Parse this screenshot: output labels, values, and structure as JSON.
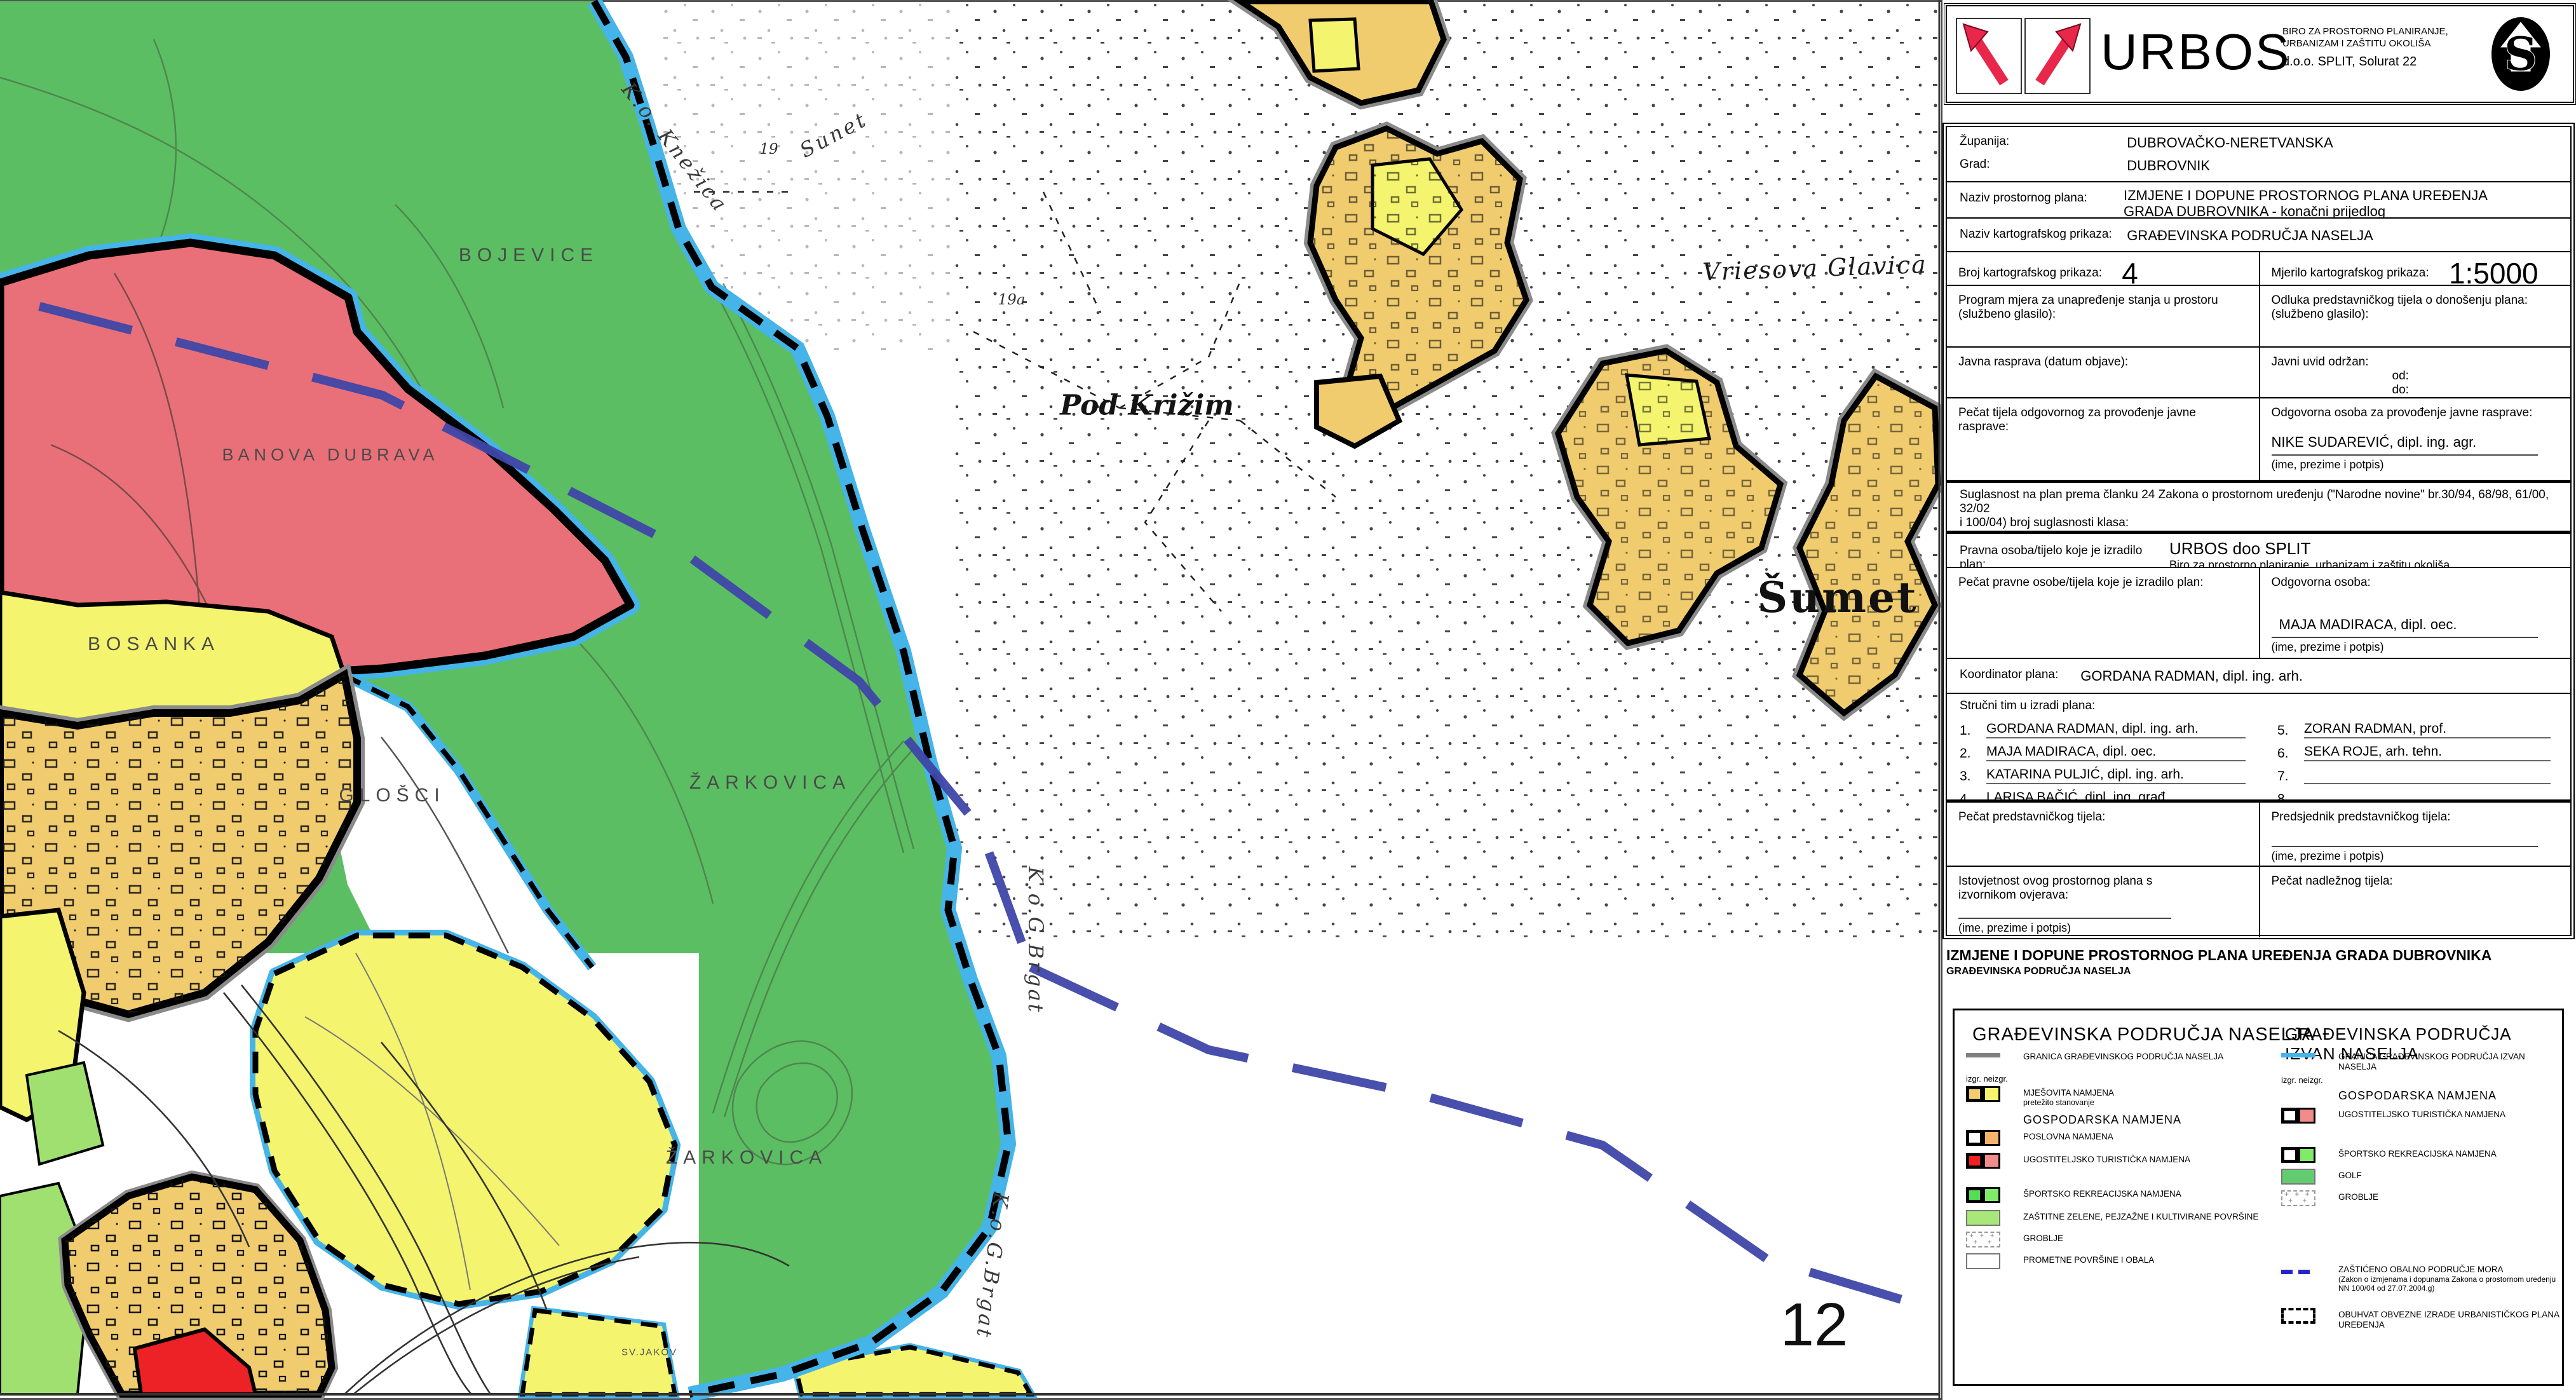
{
  "header": {
    "brand": "URBOS",
    "tagline1": "BIRO ZA PROSTORNO PLANIRANJE,",
    "tagline2": "URBANIZAM I ZAŠTITU OKOLIŠA",
    "address": "d.o.o. SPLIT, Solurat 22",
    "logo_letter": "S"
  },
  "title_block": {
    "zupanija_label": "Županija:",
    "zupanija_value": "DUBROVAČKO-NERETVANSKA",
    "grad_label": "Grad:",
    "grad_value": "DUBROVNIK",
    "naziv_plana_label": "Naziv prostornog plana:",
    "naziv_plana_value1": "IZMJENE I DOPUNE PROSTORNOG PLANA UREĐENJA",
    "naziv_plana_value2": "GRADA DUBROVNIKA - konačni prijedlog",
    "naziv_prikaza_label": "Naziv kartografskog prikaza:",
    "naziv_prikaza_value": "GRAĐEVINSKA PODRUČJA NASELJA",
    "broj_label": "Broj kartografskog prikaza:",
    "broj_value": "4",
    "mjerilo_label": "Mjerilo kartografskog prikaza:",
    "mjerilo_value": "1:5000",
    "program_label1": "Program mjera za unapređenje stanja u prostoru",
    "program_label2": "(službeno glasilo):",
    "odluka_label1": "Odluka predstavničkog tijela o donošenju plana:",
    "odluka_label2": "(službeno glasilo):",
    "javna_label": "Javna rasprava (datum objave):",
    "javni_uvid_label": "Javni uvid održan:",
    "od_label": "od:",
    "do_label": "do:",
    "pecat_tijela_label": "Pečat tijela odgovornog za provođenje javne rasprave:",
    "odgovorna_rasprava_label": "Odgovorna osoba za provođenje javne rasprave:",
    "odgovorna_rasprava_name": "NIKE SUDAREVIĆ, dipl. ing. agr.",
    "ime_potpis": "(ime, prezime i potpis)",
    "suglasnost_text1": "Suglasnost na plan prema članku 24 Zakona o prostornom uređenju (\"Narodne novine\" br.30/94, 68/98, 61/00, 32/02",
    "suglasnost_text2": "i 100/04) broj suglasnosti klasa:",
    "datum_label": "datum:",
    "pravna_label": "Pravna osoba/tijelo koje je izradilo plan:",
    "pravna_value1": "URBOS doo SPLIT",
    "pravna_value2": "Biro za prostorno planiranje, urbanizam i zaštitu okoliša",
    "pecat_pravne_label": "Pečat pravne osobe/tijela koje je izradilo plan:",
    "odgovorna_label": "Odgovorna osoba:",
    "odgovorna_name": "MAJA MADIRACA,  dipl. oec.",
    "koordinator_label": "Koordinator plana:",
    "koordinator_value": "GORDANA RADMAN,  dipl. ing. arh.",
    "tim_label": "Stručni tim u izradi plana:",
    "tim": [
      {
        "num": "1.",
        "name": "GORDANA RADMAN,  dipl. ing. arh."
      },
      {
        "num": "2.",
        "name": "MAJA MADIRACA,  dipl. oec."
      },
      {
        "num": "3.",
        "name": "KATARINA PULJIĆ,  dipl. ing. arh."
      },
      {
        "num": "4.",
        "name": "LARISA BAČIĆ,  dipl. ing. građ."
      },
      {
        "num": "5.",
        "name": "ZORAN RADMAN,  prof."
      },
      {
        "num": "6.",
        "name": "SEKA ROJE,  arh. tehn."
      },
      {
        "num": "7.",
        "name": ""
      },
      {
        "num": "8.",
        "name": ""
      }
    ],
    "pecat_predstavnickog_label": "Pečat predstavničkog tijela:",
    "predsjednik_label": "Predsjednik predstavničkog tijela:",
    "istovjetnost_label": "Istovjetnost ovog prostornog plana s izvornikom ovjerava:",
    "pecat_nadleznog_label": "Pečat nadležnog tijela:"
  },
  "captions": {
    "line1": "IZMJENE I DOPUNE PROSTORNOG PLANA UREĐENJA GRADA DUBROVNIKA",
    "line2": "GRAĐEVINSKA PODRUČJA NASELJA"
  },
  "legend_left": {
    "title": "GRAĐEVINSKA PODRUČJA NASELJA",
    "granica_label": "GRANICA GRAĐEVINSKOG PODRUČJA NASELJA",
    "izgr_label": "izgr.   neizgr.",
    "mjesovita_label": "MJEŠOVITA NAMJENA",
    "mjesovita_sub": "pretežito stanovanje",
    "gospodarska_header": "GOSPODARSKA NAMJENA",
    "poslovna_label": "POSLOVNA NAMJENA",
    "ugostiteljsko_label": "UGOSTITELJSKO TURISTIČKA NAMJENA",
    "sportsko_label": "ŠPORTSKO REKREACIJSKA NAMJENA",
    "zastitne_label": "ZAŠTITNE ZELENE, PEJZAŽNE I KULTIVIRANE POVRŠINE",
    "groblje_label": "GROBLJE",
    "prometne_label": "PROMETNE POVRŠINE I OBALA"
  },
  "legend_right": {
    "title": "GRAĐEVINSKA PODRUČJA IZVAN NASELJA",
    "granica_label": "GRANICA GRAĐEVINSKOG PODRUČJA IZVAN NASELJA",
    "izgr_label": "izgr.   neizgr.",
    "gospodarska_header": "GOSPODARSKA NAMJENA",
    "ugostiteljsko_label": "UGOSTITELJSKO TURISTIČKA NAMJENA",
    "sportsko_label": "ŠPORTSKO REKREACIJSKA NAMJENA",
    "golf_label": "GOLF",
    "groblje_label": "GROBLJE",
    "zop_line1": "ZAŠTIĆENO OBALNO PODRUČJE MORA",
    "zop_line2": "(Zakon o izmjenama i dopunama Zakona o prostornom uređenju",
    "zop_line3": "NN 100/04 od 27.07.2004.g)",
    "obuhvat_label": "OBUHVAT OBVEZNE IZRADE URBANISTIČKOG PLANA UREĐENJA"
  },
  "map": {
    "sheet_number": "12",
    "labels": [
      "K.o. Knežica",
      "Sunet",
      "19",
      "19a",
      "BOJEVICE",
      "BANOVA DUBRAVA",
      "BOSANKA",
      "GLOŠCI",
      "ŽARKOVICA",
      "ŽARKOVICA",
      "Pod Križim",
      "Vriesova Glavica",
      "Šumet",
      "K.o.G.Brgat",
      "K.o.G.Brgat",
      "SV.JAKOV"
    ],
    "colors": {
      "zone_green": "#5CBE62",
      "zone_light_green": "#A0E070",
      "zone_yellow": "#F4F46E",
      "zone_mixed_built": "#F0CC6E",
      "zone_business": "#F5B46E",
      "zone_tourism_built": "#EE2020",
      "zone_tourism_unbuilt": "#F28C8C",
      "zone_golf": "#63CC70",
      "boundary_cyan": "#45B4E8",
      "boundary_gray": "#808080",
      "coastal_navy": "#3F46A8"
    }
  }
}
